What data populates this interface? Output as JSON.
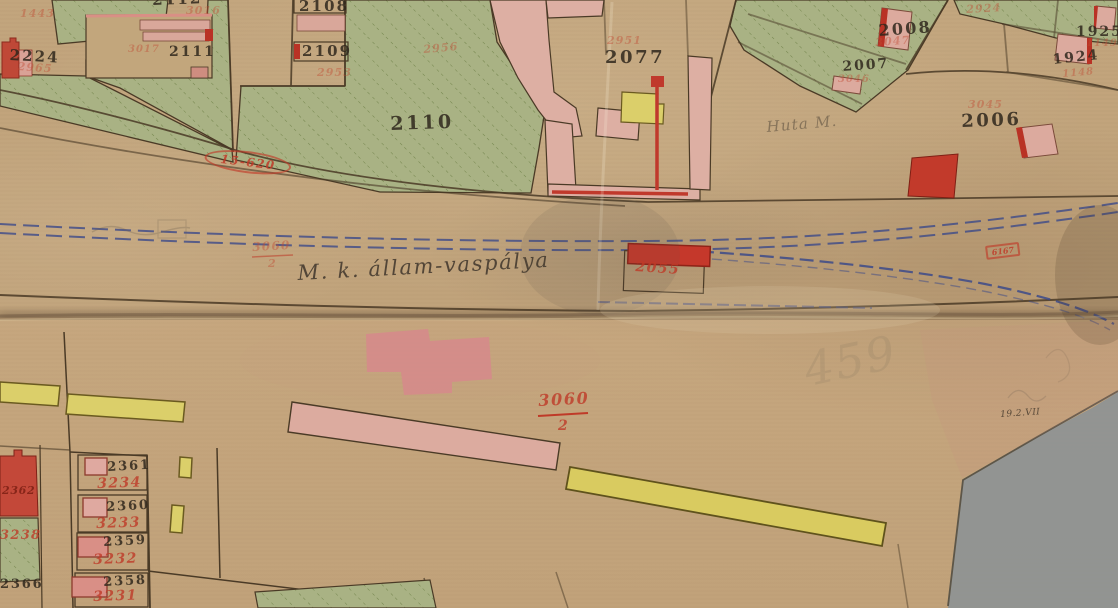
{
  "map": {
    "kind": "historical-cadastral-map",
    "railway_caption": "M. k. állam-vaspálya",
    "stamps": {
      "oval": "15-620",
      "box": "6167"
    },
    "colors": {
      "paper": "#c2a57d",
      "green_parcel": "#a9b284",
      "pink_building": "#dcab9f",
      "red_building": "#c23a2b",
      "yellow_building": "#dbcf6a",
      "railway_blue": "#3c4a8a",
      "ink": "#4a3a26",
      "red_ink": "#bf3a28"
    }
  },
  "labels": [
    {
      "text": "2112",
      "x": 152,
      "y": -7,
      "size": 15,
      "rot": -2,
      "kind": "black"
    },
    {
      "text": "2108",
      "x": 299,
      "y": -1,
      "size": 15,
      "rot": 0,
      "kind": "black"
    },
    {
      "text": "2109",
      "x": 302,
      "y": 44,
      "size": 15,
      "rot": 0,
      "kind": "black"
    },
    {
      "text": "2111",
      "x": 169,
      "y": 45,
      "size": 14,
      "rot": 0,
      "kind": "black"
    },
    {
      "text": "2224",
      "x": 10,
      "y": 48,
      "size": 15,
      "rot": 3,
      "kind": "black"
    },
    {
      "text": "2110",
      "x": 390,
      "y": 115,
      "size": 19,
      "rot": -2,
      "kind": "black"
    },
    {
      "text": "2077",
      "x": 605,
      "y": 49,
      "size": 18,
      "rot": 0,
      "kind": "black"
    },
    {
      "text": "2008",
      "x": 878,
      "y": 23,
      "size": 16,
      "rot": -4,
      "kind": "black"
    },
    {
      "text": "2007",
      "x": 842,
      "y": 60,
      "size": 14,
      "rot": -4,
      "kind": "black"
    },
    {
      "text": "2006",
      "x": 961,
      "y": 113,
      "size": 18,
      "rot": -2,
      "kind": "black"
    },
    {
      "text": "1925",
      "x": 1076,
      "y": 25,
      "size": 14,
      "rot": 0,
      "kind": "black"
    },
    {
      "text": "1924",
      "x": 1052,
      "y": 53,
      "size": 14,
      "rot": -6,
      "kind": "black"
    },
    {
      "text": "2361",
      "x": 107,
      "y": 461,
      "size": 13,
      "rot": -3,
      "kind": "black"
    },
    {
      "text": "2360",
      "x": 106,
      "y": 501,
      "size": 13,
      "rot": -3,
      "kind": "black"
    },
    {
      "text": "2359",
      "x": 103,
      "y": 536,
      "size": 13,
      "rot": -3,
      "kind": "black"
    },
    {
      "text": "2358",
      "x": 103,
      "y": 576,
      "size": 13,
      "rot": -3,
      "kind": "black"
    },
    {
      "text": "2366",
      "x": 0,
      "y": 578,
      "size": 13,
      "rot": 0,
      "kind": "black"
    },
    {
      "text": "19.2.VII",
      "x": 1000,
      "y": 411,
      "size": 9,
      "rot": -4,
      "kind": "black-small"
    },
    {
      "text": "3234",
      "x": 97,
      "y": 477,
      "size": 14,
      "rot": -2,
      "kind": "red"
    },
    {
      "text": "3233",
      "x": 96,
      "y": 517,
      "size": 14,
      "rot": -2,
      "kind": "red"
    },
    {
      "text": "3232",
      "x": 93,
      "y": 553,
      "size": 14,
      "rot": -2,
      "kind": "red"
    },
    {
      "text": "3231",
      "x": 93,
      "y": 590,
      "size": 14,
      "rot": -2,
      "kind": "red"
    },
    {
      "text": "2055",
      "x": 636,
      "y": 260,
      "size": 14,
      "rot": 4,
      "kind": "red"
    },
    {
      "text": "3060",
      "x": 538,
      "y": 393,
      "size": 16,
      "rot": -3,
      "kind": "red"
    },
    {
      "text": "2",
      "x": 558,
      "y": 419,
      "size": 14,
      "rot": 0,
      "kind": "red"
    },
    {
      "text": "3060",
      "x": 252,
      "y": 241,
      "size": 12,
      "rot": -3,
      "kind": "red-faint"
    },
    {
      "text": "2",
      "x": 268,
      "y": 258,
      "size": 11,
      "rot": 0,
      "kind": "red-faint"
    },
    {
      "text": "3238",
      "x": 0,
      "y": 529,
      "size": 13,
      "rot": 0,
      "kind": "red"
    },
    {
      "text": "2362",
      "x": 2,
      "y": 485,
      "size": 11,
      "rot": 0,
      "kind": "darkred"
    },
    {
      "text": "2951",
      "x": 607,
      "y": 35,
      "size": 11,
      "rot": 0,
      "kind": "red-faint"
    },
    {
      "text": "2956",
      "x": 423,
      "y": 44,
      "size": 11,
      "rot": -5,
      "kind": "red-faint"
    },
    {
      "text": "2953",
      "x": 317,
      "y": 67,
      "size": 11,
      "rot": 0,
      "kind": "red-faint"
    },
    {
      "text": "3016",
      "x": 186,
      "y": 5,
      "size": 11,
      "rot": 0,
      "kind": "red-faint"
    },
    {
      "text": "2965",
      "x": 18,
      "y": 61,
      "size": 11,
      "rot": 4,
      "kind": "red-faint"
    },
    {
      "text": "1443",
      "x": 20,
      "y": 8,
      "size": 11,
      "rot": 0,
      "kind": "red-faint"
    },
    {
      "text": "3017",
      "x": 128,
      "y": 45,
      "size": 10,
      "rot": 0,
      "kind": "red-faint"
    },
    {
      "text": "3047",
      "x": 875,
      "y": 37,
      "size": 11,
      "rot": -4,
      "kind": "red-faint"
    },
    {
      "text": "2924",
      "x": 966,
      "y": 4,
      "size": 11,
      "rot": -3,
      "kind": "red-faint"
    },
    {
      "text": "3045",
      "x": 968,
      "y": 99,
      "size": 11,
      "rot": 0,
      "kind": "red-faint"
    },
    {
      "text": "1149",
      "x": 1086,
      "y": 39,
      "size": 10,
      "rot": 0,
      "kind": "red-faint"
    },
    {
      "text": "1148",
      "x": 1062,
      "y": 70,
      "size": 10,
      "rot": -5,
      "kind": "red-faint"
    },
    {
      "text": "3046",
      "x": 838,
      "y": 75,
      "size": 10,
      "rot": 0,
      "kind": "red-faint"
    },
    {
      "text": "M. k. állam-vaspálya",
      "x": 297,
      "y": 263,
      "size": 21,
      "rot": -3,
      "kind": "script"
    },
    {
      "text": "Huta M.",
      "x": 766,
      "y": 120,
      "size": 15,
      "rot": -5,
      "kind": "script-faint"
    },
    {
      "text": "459",
      "x": 800,
      "y": 348,
      "size": 46,
      "rot": -12,
      "kind": "pencil"
    },
    {
      "text": "15-620",
      "x": 206,
      "y": 146,
      "size": 12,
      "rot": 7,
      "kind": "stamp-oval"
    },
    {
      "text": "6167",
      "x": 985,
      "y": 246,
      "size": 8,
      "rot": -7,
      "kind": "stamp-box"
    }
  ]
}
